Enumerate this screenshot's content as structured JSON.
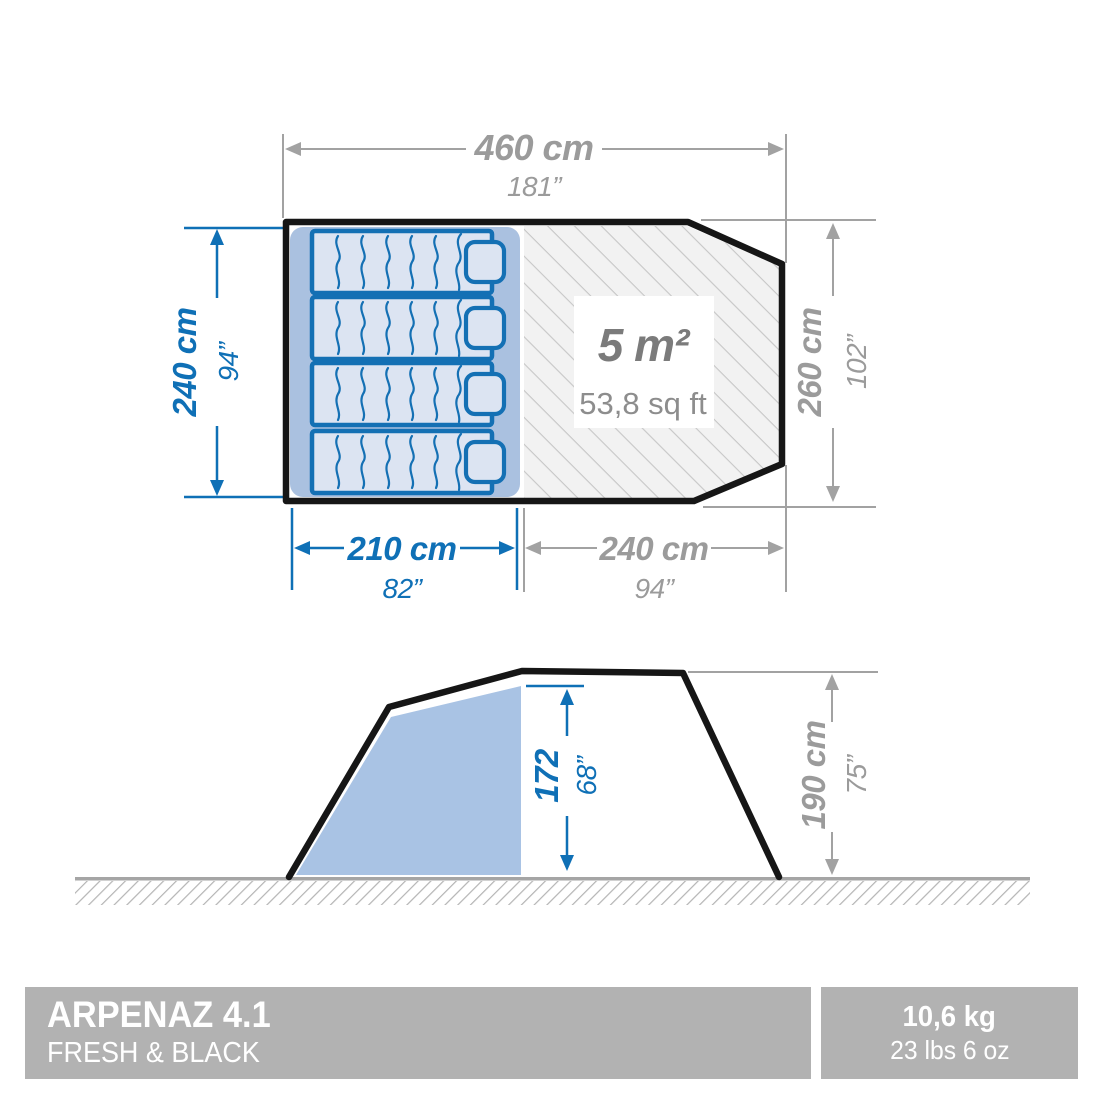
{
  "plan_view": {
    "total_width": {
      "cm": "460 cm",
      "inches": "181”"
    },
    "bedroom_depth": {
      "cm": "240 cm",
      "inches": "94”"
    },
    "total_depth": {
      "cm": "260 cm",
      "inches": "102”"
    },
    "bedroom_width": {
      "cm": "210 cm",
      "inches": "82”"
    },
    "living_width": {
      "cm": "240 cm",
      "inches": "94”"
    },
    "living_area": {
      "metric": "5 m²",
      "imperial": "53,8 sq ft"
    }
  },
  "side_view": {
    "interior_height": {
      "cm": "172",
      "inches": "68”"
    },
    "exterior_height": {
      "cm": "190 cm",
      "inches": "75”"
    }
  },
  "banner": {
    "product_name": "ARPENAZ 4.1",
    "product_line": "FRESH & BLACK",
    "weight_metric": "10,6 kg",
    "weight_imperial": "23 lbs 6 oz"
  },
  "colors": {
    "dimension_blue": "#0f70b6",
    "dimension_gray": "#9b9b9b",
    "bedroom_fill": "#aac1e0",
    "mattress_fill": "#dce4f2",
    "mattress_stroke": "#1470b4",
    "outline_black": "#161616",
    "hatch_gray": "#c7c7c7",
    "banner_gray": "#b2b2b2"
  }
}
